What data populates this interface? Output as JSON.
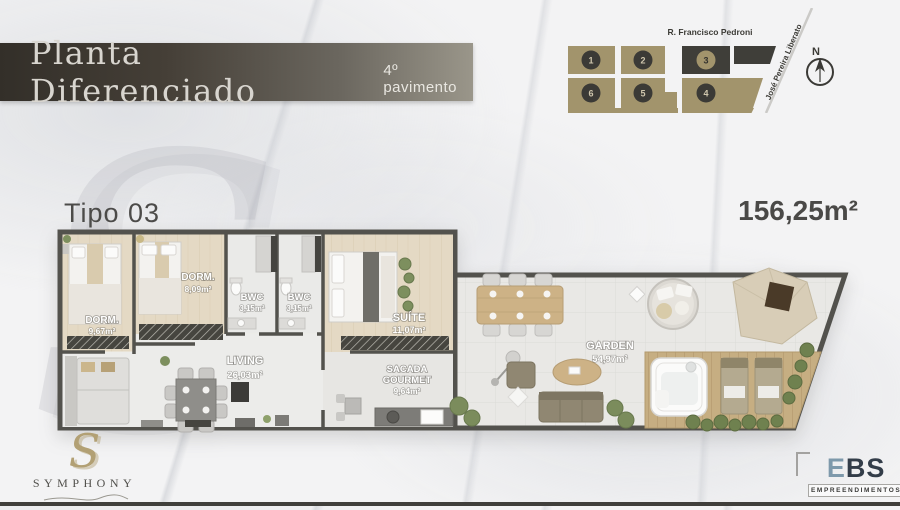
{
  "banner": {
    "title": "Planta Diferenciado",
    "subtitle": "4º pavimento"
  },
  "site_map": {
    "street_top": "R. Francisco Pedroni",
    "street_side": "José Pereira Liberato",
    "north": "N",
    "unit1": "1",
    "unit2": "2",
    "unit3": "3",
    "unit4": "4",
    "unit5": "5",
    "unit6": "6"
  },
  "plan": {
    "type": "Tipo 03",
    "total_area": "156,25m²",
    "rooms": {
      "dorm1": {
        "name": "DORM.",
        "area": "9,67m²"
      },
      "dorm2": {
        "name": "DORM.",
        "area": "8,09m²"
      },
      "bwc1": {
        "name": "BWC",
        "area": "3,15m²"
      },
      "bwc2": {
        "name": "BWC",
        "area": "3,15m²"
      },
      "suite": {
        "name": "SUÍTE",
        "area": "11,07m²"
      },
      "living": {
        "name": "LIVING",
        "area": "26,03m²"
      },
      "sacada": {
        "line1": "SACADA",
        "line2": "GOURMET",
        "area": "9,64m²"
      },
      "garden": {
        "name": "GARDEN",
        "area": "54,97m²"
      }
    }
  },
  "logos": {
    "symphony": {
      "monogram": "S",
      "name": "SYMPHONY"
    },
    "ebs": {
      "part1": "E",
      "part2": "BS",
      "tagline": "EMPREENDIMENTOS"
    }
  },
  "watermark": "S",
  "colors": {
    "accent_tan": "#a2946c",
    "block_dark": "#3f3e39",
    "banner_dark": "#332f29",
    "wall": "#53524d",
    "deck_wood": "#c6ae82",
    "ebs_blue": "#7e99ab"
  }
}
